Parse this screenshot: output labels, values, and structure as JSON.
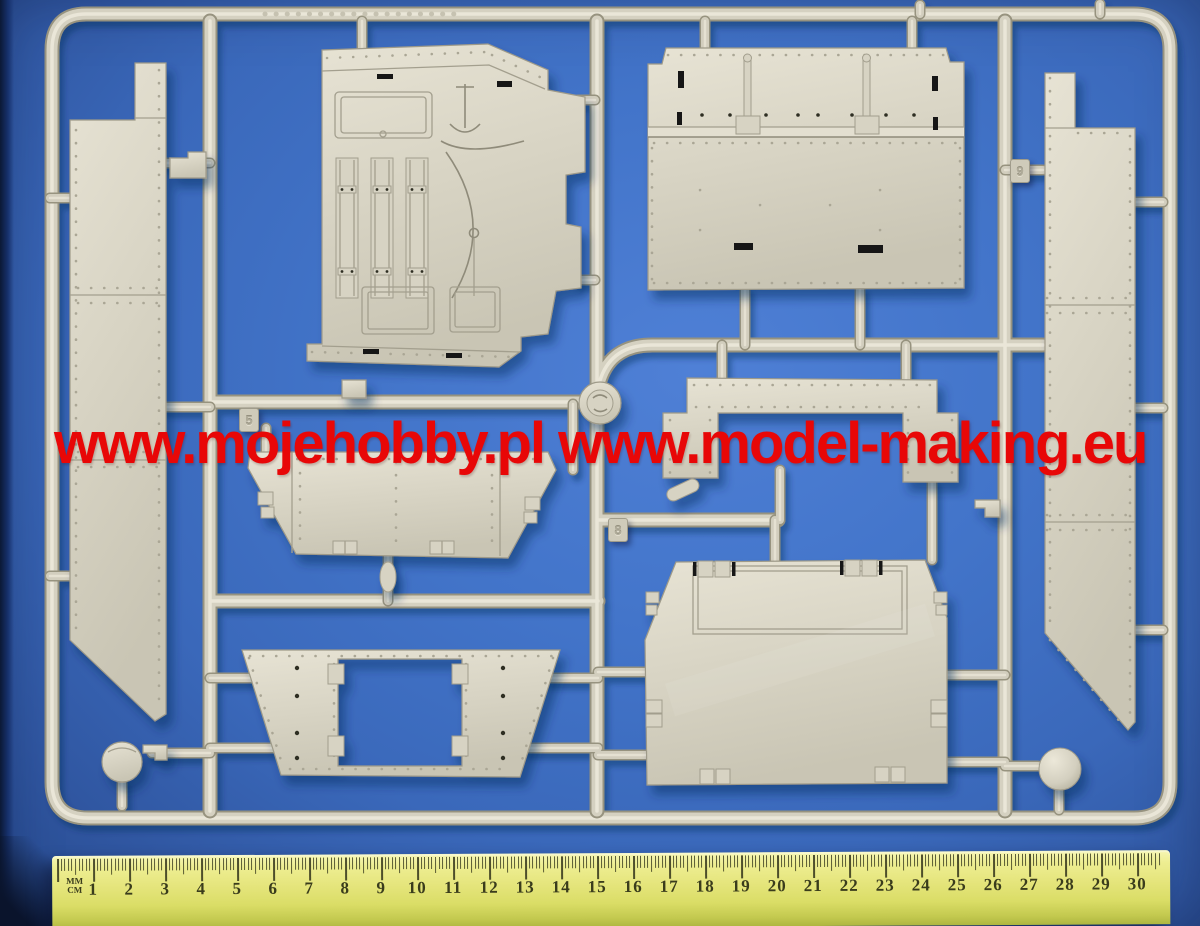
{
  "watermark": {
    "text": "www.mojehobby.pl www.model-making.eu",
    "color": "#e80707"
  },
  "sprue": {
    "plastic_color": "#d6d2c2",
    "part_tags": [
      {
        "id": "tag-5",
        "label": "5"
      },
      {
        "id": "tag-8",
        "label": "8"
      },
      {
        "id": "tag-9",
        "label": "9"
      }
    ],
    "parts": [
      "sprue-frame",
      "left-side-armor-panel",
      "hull-roof-panel",
      "upper-rear-hull-panel",
      "right-side-armor-panel",
      "lower-glacis-plate",
      "fender-bridge-bracket",
      "bottom-plate-with-opening",
      "rear-hull-plate",
      "idler-wheel",
      "cover-disc",
      "ball-mount"
    ]
  },
  "ruler": {
    "label_top": "MM",
    "label_bottom": "CM",
    "numbers": [
      1,
      2,
      3,
      4,
      5,
      6,
      7,
      8,
      9,
      10,
      11,
      12,
      13,
      14,
      15,
      16,
      17,
      18,
      19,
      20,
      21,
      22,
      23,
      24,
      25,
      26,
      27,
      28,
      29,
      30
    ],
    "body_color": "#e5e57c",
    "marking_color": "#3a3c1c"
  },
  "background": {
    "base_color": "#3f6fc2"
  }
}
